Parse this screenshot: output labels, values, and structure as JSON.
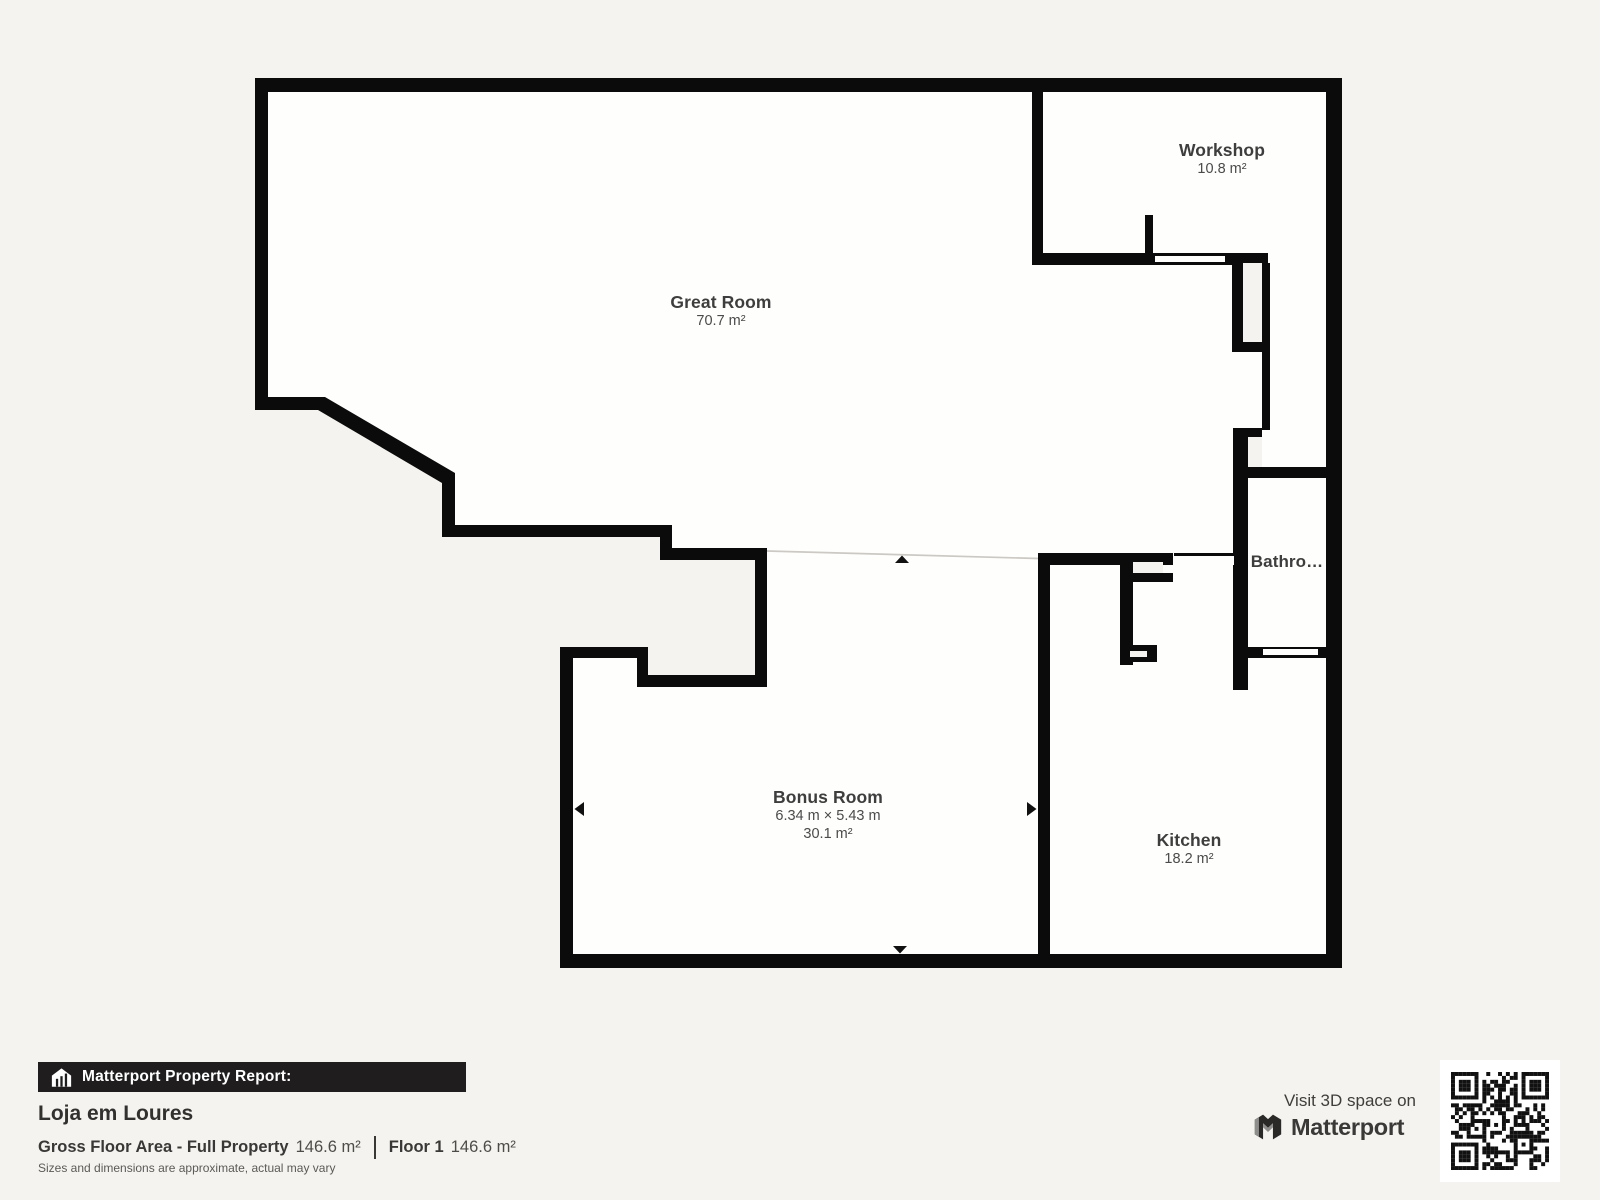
{
  "colors": {
    "background": "#f4f3f0",
    "wall": "#0b0b0b",
    "floor": "#fefefc",
    "open_boundary_line": "#ccc9c4",
    "banner_bg": "#1f1d1d",
    "banner_text": "#ffffff",
    "room_text": "#3e3e3e"
  },
  "rooms": {
    "great_room": {
      "name": "Great Room",
      "area": "70.7 m²"
    },
    "workshop": {
      "name": "Workshop",
      "area": "10.8 m²"
    },
    "bathroom": {
      "name": "Bathro…"
    },
    "bonus_room": {
      "name": "Bonus Room",
      "dimensions": "6.34 m × 5.43 m",
      "area": "30.1 m²"
    },
    "kitchen": {
      "name": "Kitchen",
      "area": "18.2 m²"
    }
  },
  "footer": {
    "report_label": "Matterport Property Report:",
    "property_name": "Loja em Loures",
    "gross_label": "Gross Floor Area - Full Property",
    "gross_value": "146.6 m²",
    "floor_label": "Floor 1",
    "floor_value": "146.6 m²",
    "disclaimer": "Sizes and dimensions are approximate, actual may vary"
  },
  "promo": {
    "visit_text": "Visit 3D space on",
    "brand": "Matterport"
  }
}
